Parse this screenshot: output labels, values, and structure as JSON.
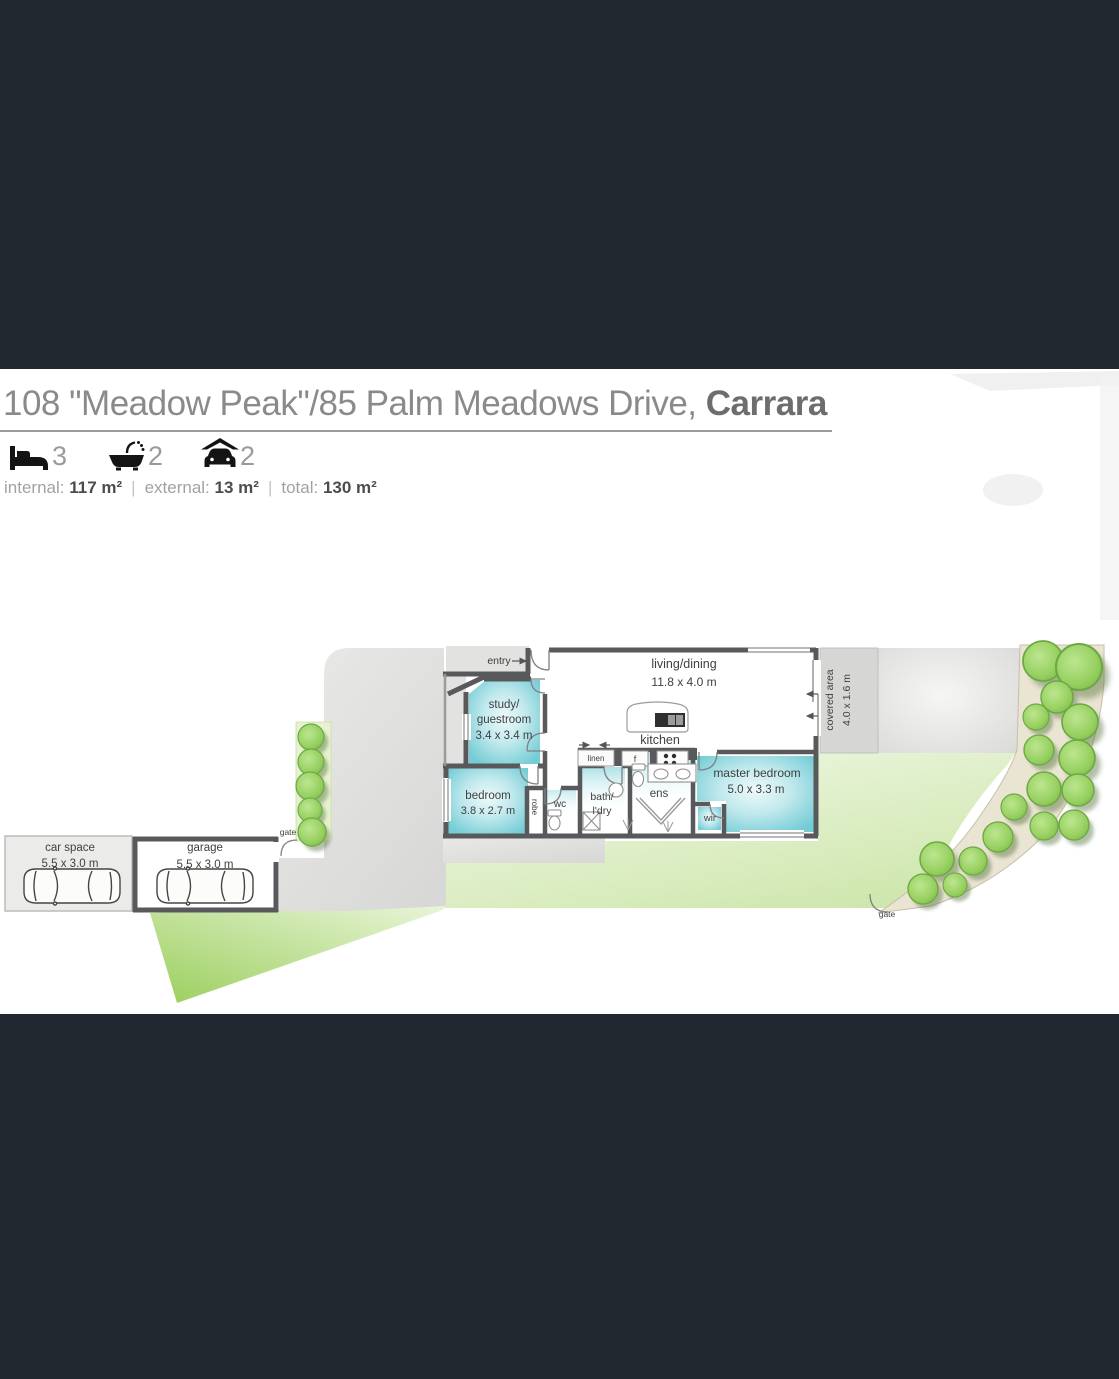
{
  "colors": {
    "band": "#212830",
    "wall": "#58595b",
    "room_teal": "#7fd0d8",
    "lawn_bright": "#9ccf5f",
    "lawn_pale": "#d9edbc",
    "driveway": "#e0e0de",
    "tree": "#94ce5e",
    "path_beige": "#eae4d3",
    "title_gray": "#8a8a8a"
  },
  "header": {
    "title_prefix": "108 \"Meadow Peak\"/85 Palm Meadows Drive, ",
    "title_suffix": "Carrara",
    "beds": "3",
    "baths": "2",
    "cars": "2",
    "areas": {
      "internal_label": "internal:",
      "internal_value": "117 m²",
      "external_label": "external:",
      "external_value": "13 m²",
      "total_label": "total:",
      "total_value": "130 m²",
      "sep": "|"
    }
  },
  "plan": {
    "entry": "entry",
    "living_name": "living/dining",
    "living_dims": "11.8 x 4.0 m",
    "kitchen": "kitchen",
    "study_l1": "study/",
    "study_l2": "guestroom",
    "study_dims": "3.4 x 3.4 m",
    "bedroom_name": "bedroom",
    "bedroom_dims": "3.8 x 2.7 m",
    "master_name": "master bedroom",
    "master_dims": "5.0 x 3.3 m",
    "bath_l1": "bath/",
    "bath_l2": "l'dry",
    "ens": "ens",
    "wc": "wc",
    "wir": "wir",
    "robe": "robe",
    "linen": "linen",
    "fridge": "f",
    "covered_name": "covered area",
    "covered_dims": "4.0 x 1.6 m",
    "car_space_name": "car space",
    "car_space_dims": "5.5 x 3.0 m",
    "garage_name": "garage",
    "garage_dims": "5.5 x 3.0 m",
    "gate_left": "gate",
    "gate_right": "gate"
  }
}
